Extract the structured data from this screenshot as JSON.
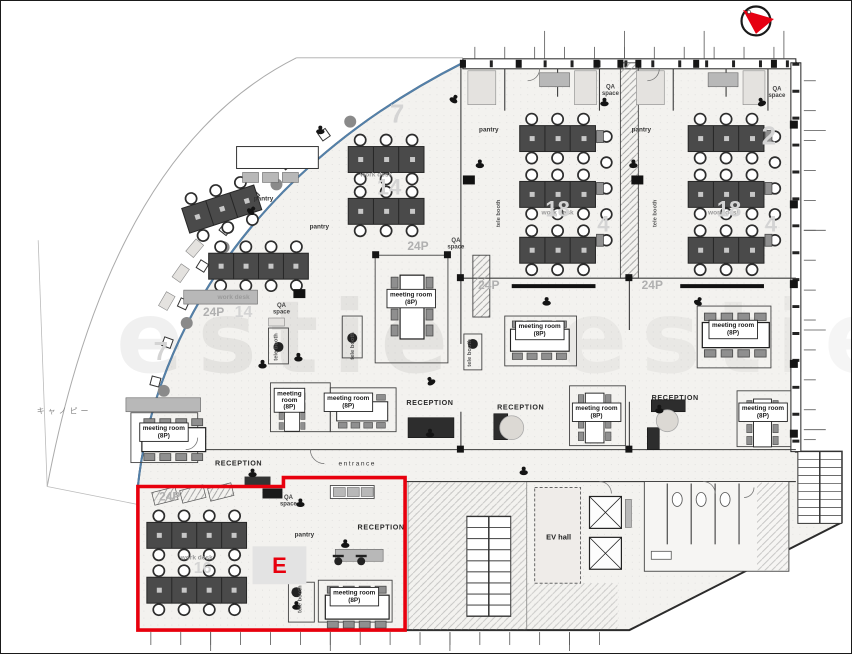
{
  "page": {
    "width": 852,
    "height": 654,
    "background": "#ffffff",
    "border_color": "#1a1a1a"
  },
  "palette": {
    "wall": "#2b2b2b",
    "desk": "#4a4a4a",
    "facade_blue": "#5a8fc0",
    "accent_red": "#e8000d",
    "faint_number": "#d4d4d4"
  },
  "compass": {
    "icon": "north-arrow",
    "ring_color": "#1a1a1a",
    "arrow_color": "#e60012"
  },
  "watermark": {
    "text": "estie"
  },
  "highlight_zone": {
    "label": "E",
    "color": "#e8000d"
  },
  "floor_plan": {
    "room_labels": [
      {
        "t": "meeting room\n(8P)",
        "x": 163,
        "y": 434,
        "cls": "roombox"
      },
      {
        "t": "meeting room\n(8P)",
        "x": 411,
        "y": 300,
        "cls": "roombox"
      },
      {
        "t": "meeting room\n(8P)",
        "x": 354,
        "y": 599,
        "cls": "roombox"
      },
      {
        "t": "meeting room\n(8P)",
        "x": 597,
        "y": 414,
        "cls": "roombox"
      },
      {
        "t": "meeting room\n(8P)",
        "x": 540,
        "y": 332,
        "cls": "roombox"
      },
      {
        "t": "meeting room\n(8P)",
        "x": 734,
        "y": 331,
        "cls": "roombox"
      },
      {
        "t": "meeting room\n(8P)",
        "x": 764,
        "y": 414,
        "cls": "roombox"
      },
      {
        "t": "meeting\nroom\n(8P)",
        "x": 289,
        "y": 402,
        "cls": "roombox",
        "ls": 6.5
      },
      {
        "t": "meeting room\n(8P)",
        "x": 348,
        "y": 404,
        "cls": "roombox"
      },
      {
        "t": "RECEPTION",
        "x": 238,
        "y": 466,
        "cls": "rec"
      },
      {
        "t": "RECEPTION",
        "x": 430,
        "y": 405,
        "cls": "rec"
      },
      {
        "t": "RECEPTION",
        "x": 381,
        "y": 530,
        "cls": "rec"
      },
      {
        "t": "RECEPTION",
        "x": 521,
        "y": 410,
        "cls": "rec"
      },
      {
        "t": "RECEPTION",
        "x": 676,
        "y": 400,
        "cls": "rec"
      },
      {
        "t": "pantry",
        "x": 263,
        "y": 200,
        "cls": "small"
      },
      {
        "t": "pantry",
        "x": 319,
        "y": 228,
        "cls": "small"
      },
      {
        "t": "pantry",
        "x": 489,
        "y": 131,
        "cls": "small"
      },
      {
        "t": "pantry",
        "x": 642,
        "y": 131,
        "cls": "small"
      },
      {
        "t": "pantry",
        "x": 304,
        "y": 537,
        "cls": "small"
      },
      {
        "t": "QA\nspace",
        "x": 611,
        "y": 91,
        "cls": "small2",
        "ls": 6.5
      },
      {
        "t": "QA\nspace",
        "x": 778,
        "y": 93,
        "cls": "small2",
        "ls": 6.5
      },
      {
        "t": "QA\nspace",
        "x": 456,
        "y": 245,
        "cls": "small2",
        "ls": 6.5
      },
      {
        "t": "QA\nspace",
        "x": 281,
        "y": 310,
        "cls": "small2",
        "ls": 6.5
      },
      {
        "t": "QA\nspace",
        "x": 288,
        "y": 503,
        "cls": "small2",
        "ls": 6.5
      },
      {
        "t": "work desk",
        "x": 376,
        "y": 176,
        "cls": "faintlab"
      },
      {
        "t": "work desk",
        "x": 233,
        "y": 299,
        "cls": "faintlab"
      },
      {
        "t": "work desk",
        "x": 558,
        "y": 214,
        "cls": "faintlab"
      },
      {
        "t": "work desk",
        "x": 725,
        "y": 214,
        "cls": "faintlab"
      },
      {
        "t": "work desk",
        "x": 196,
        "y": 560,
        "cls": "faintlab"
      },
      {
        "t": "tele booth",
        "x": 277,
        "y": 347,
        "cls": "vert",
        "rot": -90
      },
      {
        "t": "tele booth",
        "x": 354,
        "y": 346,
        "cls": "vert",
        "rot": -90
      },
      {
        "t": "tele booth",
        "x": 500,
        "y": 213,
        "cls": "vert",
        "rot": -90
      },
      {
        "t": "tele booth",
        "x": 657,
        "y": 213,
        "cls": "vert",
        "rot": -90
      },
      {
        "t": "tele booth",
        "x": 301,
        "y": 600,
        "cls": "vert",
        "rot": -90
      },
      {
        "t": "tele booth",
        "x": 471,
        "y": 353,
        "cls": "vert",
        "rot": -90
      },
      {
        "t": "24P",
        "x": 213,
        "y": 316,
        "cls": "zone"
      },
      {
        "t": "24P",
        "x": 418,
        "y": 250,
        "cls": "zone"
      },
      {
        "t": "24P",
        "x": 489,
        "y": 289,
        "cls": "zone"
      },
      {
        "t": "24P",
        "x": 653,
        "y": 289,
        "cls": "zone"
      },
      {
        "t": "24P",
        "x": 169,
        "y": 501,
        "cls": "zone"
      },
      {
        "t": "7",
        "x": 397,
        "y": 122,
        "cls": "big",
        "fs": 26
      },
      {
        "t": "7",
        "x": 160,
        "y": 360,
        "cls": "big",
        "fs": 26
      },
      {
        "t": "14",
        "x": 243,
        "y": 317,
        "cls": "big",
        "fs": 16
      },
      {
        "t": "14",
        "x": 389,
        "y": 194,
        "cls": "big",
        "fs": 22
      },
      {
        "t": "18",
        "x": 558,
        "y": 216,
        "cls": "big",
        "fs": 22
      },
      {
        "t": "18",
        "x": 730,
        "y": 216,
        "cls": "big",
        "fs": 22
      },
      {
        "t": "2",
        "x": 770,
        "y": 144,
        "cls": "big",
        "fs": 26
      },
      {
        "t": "4",
        "x": 604,
        "y": 231,
        "cls": "big",
        "fs": 22
      },
      {
        "t": "4",
        "x": 772,
        "y": 231,
        "cls": "big",
        "fs": 22
      },
      {
        "t": "16",
        "x": 202,
        "y": 574,
        "cls": "big",
        "fs": 16
      },
      {
        "t": "EV hall",
        "x": 559,
        "y": 540,
        "cls": "ev"
      },
      {
        "t": "entrance",
        "x": 357,
        "y": 466,
        "cls": "ent"
      },
      {
        "t": "キャノピー",
        "x": 63,
        "y": 414,
        "cls": "canopy"
      }
    ]
  }
}
